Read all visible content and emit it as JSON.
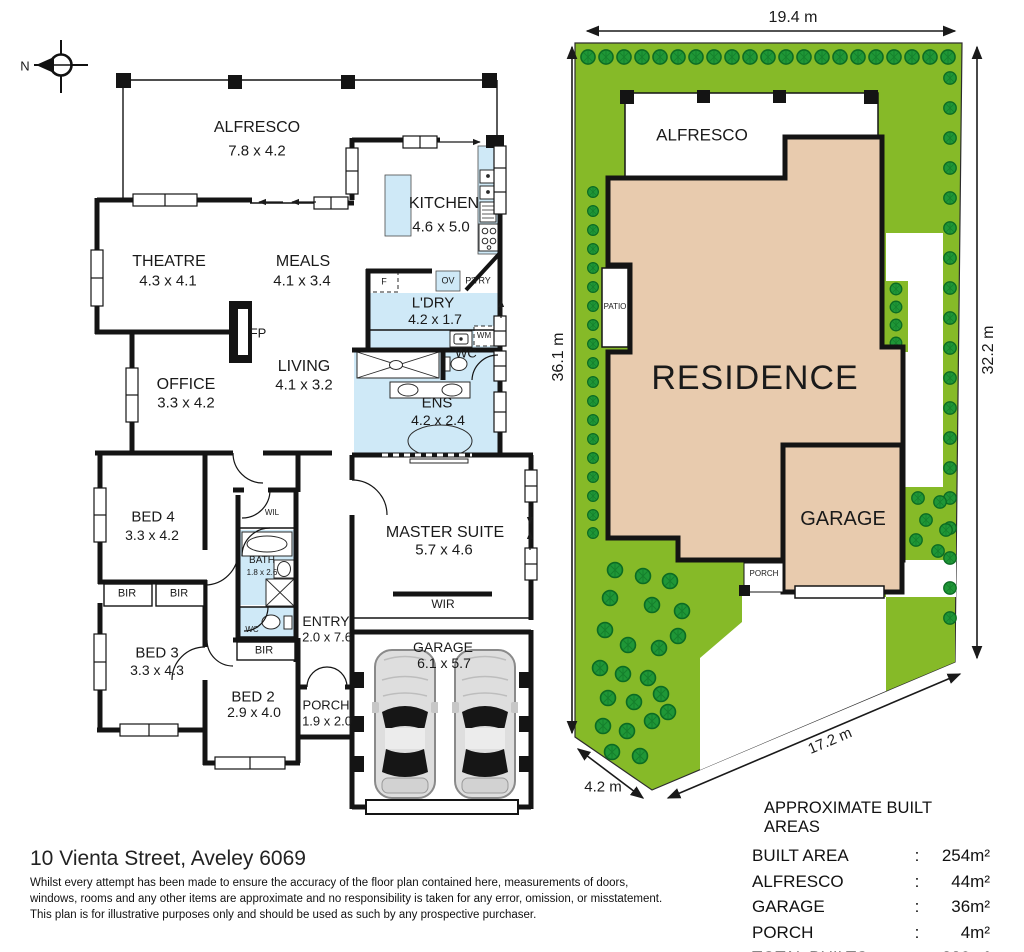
{
  "compass": {
    "north": "N"
  },
  "floorplan": {
    "alfresco": {
      "name": "ALFRESCO",
      "dims": "7.8 x 4.2"
    },
    "kitchen": {
      "name": "KITCHEN",
      "dims": "4.6 x 5.0"
    },
    "theatre": {
      "name": "THEATRE",
      "dims": "4.3 x 4.1"
    },
    "meals": {
      "name": "MEALS",
      "dims": "4.1 x 3.4"
    },
    "laundry": {
      "name": "L'DRY",
      "dims": "4.2 x 1.7"
    },
    "pantry": {
      "name": "P'TRY"
    },
    "oven": {
      "name": "OV"
    },
    "fridge": {
      "name": "F"
    },
    "washer": {
      "name": "WM"
    },
    "wc_laundry": {
      "name": "WC"
    },
    "fireplace": {
      "name": "FP"
    },
    "office": {
      "name": "OFFICE",
      "dims": "3.3 x 4.2"
    },
    "living": {
      "name": "LIVING",
      "dims": "4.1 x 3.2"
    },
    "ens": {
      "name": "ENS",
      "dims": "4.2 x 2.4"
    },
    "bed4": {
      "name": "BED 4",
      "dims": "3.3 x 4.2"
    },
    "bir1": {
      "name": "BIR"
    },
    "bir2": {
      "name": "BIR"
    },
    "wil": {
      "name": "WIL"
    },
    "bath": {
      "name": "BATH",
      "dims": "1.8 x 2.6"
    },
    "wc_bath": {
      "name": "WC"
    },
    "bir3": {
      "name": "BIR"
    },
    "bed3": {
      "name": "BED 3",
      "dims": "3.3 x 4.3"
    },
    "bed2": {
      "name": "BED 2",
      "dims": "2.9 x 4.0"
    },
    "entry": {
      "name": "ENTRY",
      "dims": "2.0 x 7.6"
    },
    "porch": {
      "name": "PORCH",
      "dims": "1.9 x 2.0"
    },
    "master": {
      "name": "MASTER SUITE",
      "dims": "5.7 x 4.6"
    },
    "wir": {
      "name": "WIR"
    },
    "garage": {
      "name": "GARAGE",
      "dims": "6.1 x 5.7"
    }
  },
  "siteplan": {
    "residence": "RESIDENCE",
    "alfresco": "ALFRESCO",
    "garage": "GARAGE",
    "patio": "PATIO",
    "porch": "PORCH",
    "dim_top": "19.4 m",
    "dim_left": "36.1 m",
    "dim_right": "32.2 m",
    "dim_diagonal": "17.2 m",
    "dim_bottom_left": "4.2 m"
  },
  "footer": {
    "address": "10 Vienta Street, Aveley 6069",
    "disclaimer_line1": "Whilst every attempt has been made to ensure the accuracy of the floor plan contained here, measurements of doors,",
    "disclaimer_line2": "windows, rooms and any other items are approximate and no responsibility is taken for any error, omission, or misstatement.",
    "disclaimer_line3": "This plan is for illustrative purposes only and should be used as such by any prospective purchaser."
  },
  "areas_table": {
    "title": "APPROXIMATE BUILT AREAS",
    "rows": [
      {
        "label": "BUILT AREA",
        "sep": ":",
        "value": "254m²"
      },
      {
        "label": "ALFRESCO",
        "sep": ":",
        "value": "44m²"
      },
      {
        "label": "GARAGE",
        "sep": ":",
        "value": "36m²"
      },
      {
        "label": "PORCH",
        "sep": ":",
        "value": "4m²"
      },
      {
        "label": "TOTAL BUILTS AREA",
        "sep": ":",
        "value": "338m²"
      }
    ]
  },
  "colors": {
    "lawn": "#86ba28",
    "tree": "#1f9737",
    "residence": "#e8cbae",
    "wet_area": "#cfe9f7",
    "wall": "#141414"
  }
}
